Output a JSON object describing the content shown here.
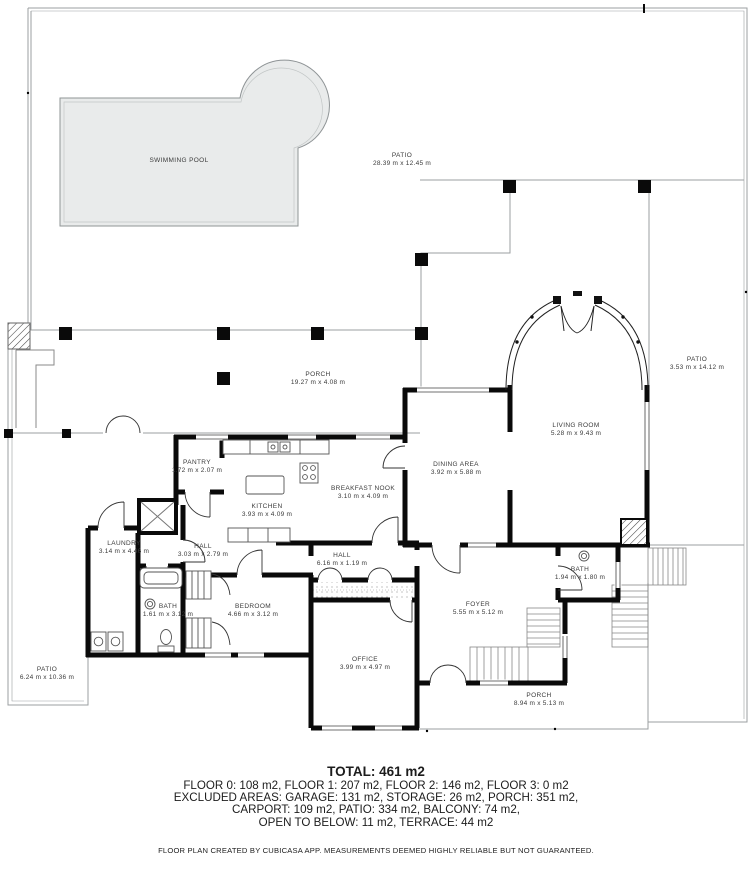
{
  "rooms": [
    {
      "name": "SWIMMING POOL",
      "dims": ""
    },
    {
      "name": "PATIO",
      "dims": "28.39 m x 12.45 m"
    },
    {
      "name": "PORCH",
      "dims": "19.27 m x 4.08 m"
    },
    {
      "name": "PATIO",
      "dims": "3.53 m x 14.12 m"
    },
    {
      "name": "LIVING ROOM",
      "dims": "5.28 m x 9.43 m"
    },
    {
      "name": "DINING AREA",
      "dims": "3.92 m x 5.88 m"
    },
    {
      "name": "BREAKFAST NOOK",
      "dims": "3.10 m x 4.09 m"
    },
    {
      "name": "KITCHEN",
      "dims": "3.93 m x 4.09 m"
    },
    {
      "name": "PANTRY",
      "dims": "1.72 m x 2.07 m"
    },
    {
      "name": "LAUNDRY",
      "dims": "3.14 m x 4.46 m"
    },
    {
      "name": "HALL",
      "dims": "3.03 m x 2.79 m"
    },
    {
      "name": "HALL",
      "dims": "6.16 m x 1.19 m"
    },
    {
      "name": "BATH",
      "dims": "1.61 m x 3.12 m"
    },
    {
      "name": "BEDROOM",
      "dims": "4.66 m x 3.12 m"
    },
    {
      "name": "OFFICE",
      "dims": "3.99 m x 4.97 m"
    },
    {
      "name": "FOYER",
      "dims": "5.55 m x 5.12 m"
    },
    {
      "name": "BATH",
      "dims": "1.94 m x 1.80 m"
    },
    {
      "name": "PORCH",
      "dims": "8.94 m x 5.13 m"
    },
    {
      "name": "PATIO",
      "dims": "6.24 m x 10.36 m"
    }
  ],
  "summary": {
    "total": "TOTAL: 461 m2",
    "line1": "FLOOR 0: 108 m2, FLOOR 1: 207 m2, FLOOR 2: 146 m2, FLOOR 3: 0 m2",
    "line2": "EXCLUDED AREAS: GARAGE: 131 m2, STORAGE: 26 m2, PORCH: 351 m2,",
    "line3": "CARPORT: 109 m2, PATIO: 334 m2, BALCONY: 74 m2,",
    "line4": "OPEN TO BELOW: 11 m2, TERRACE: 44 m2",
    "disclaimer": "FLOOR PLAN CREATED BY CUBICASA APP. MEASUREMENTS DEEMED HIGHLY RELIABLE BUT NOT GUARANTEED."
  },
  "colors": {
    "wall": "#0a0a0a",
    "boundary": "#9b9fa1",
    "pool_fill": "#e9ebeb",
    "text": "#3b3b3b"
  }
}
